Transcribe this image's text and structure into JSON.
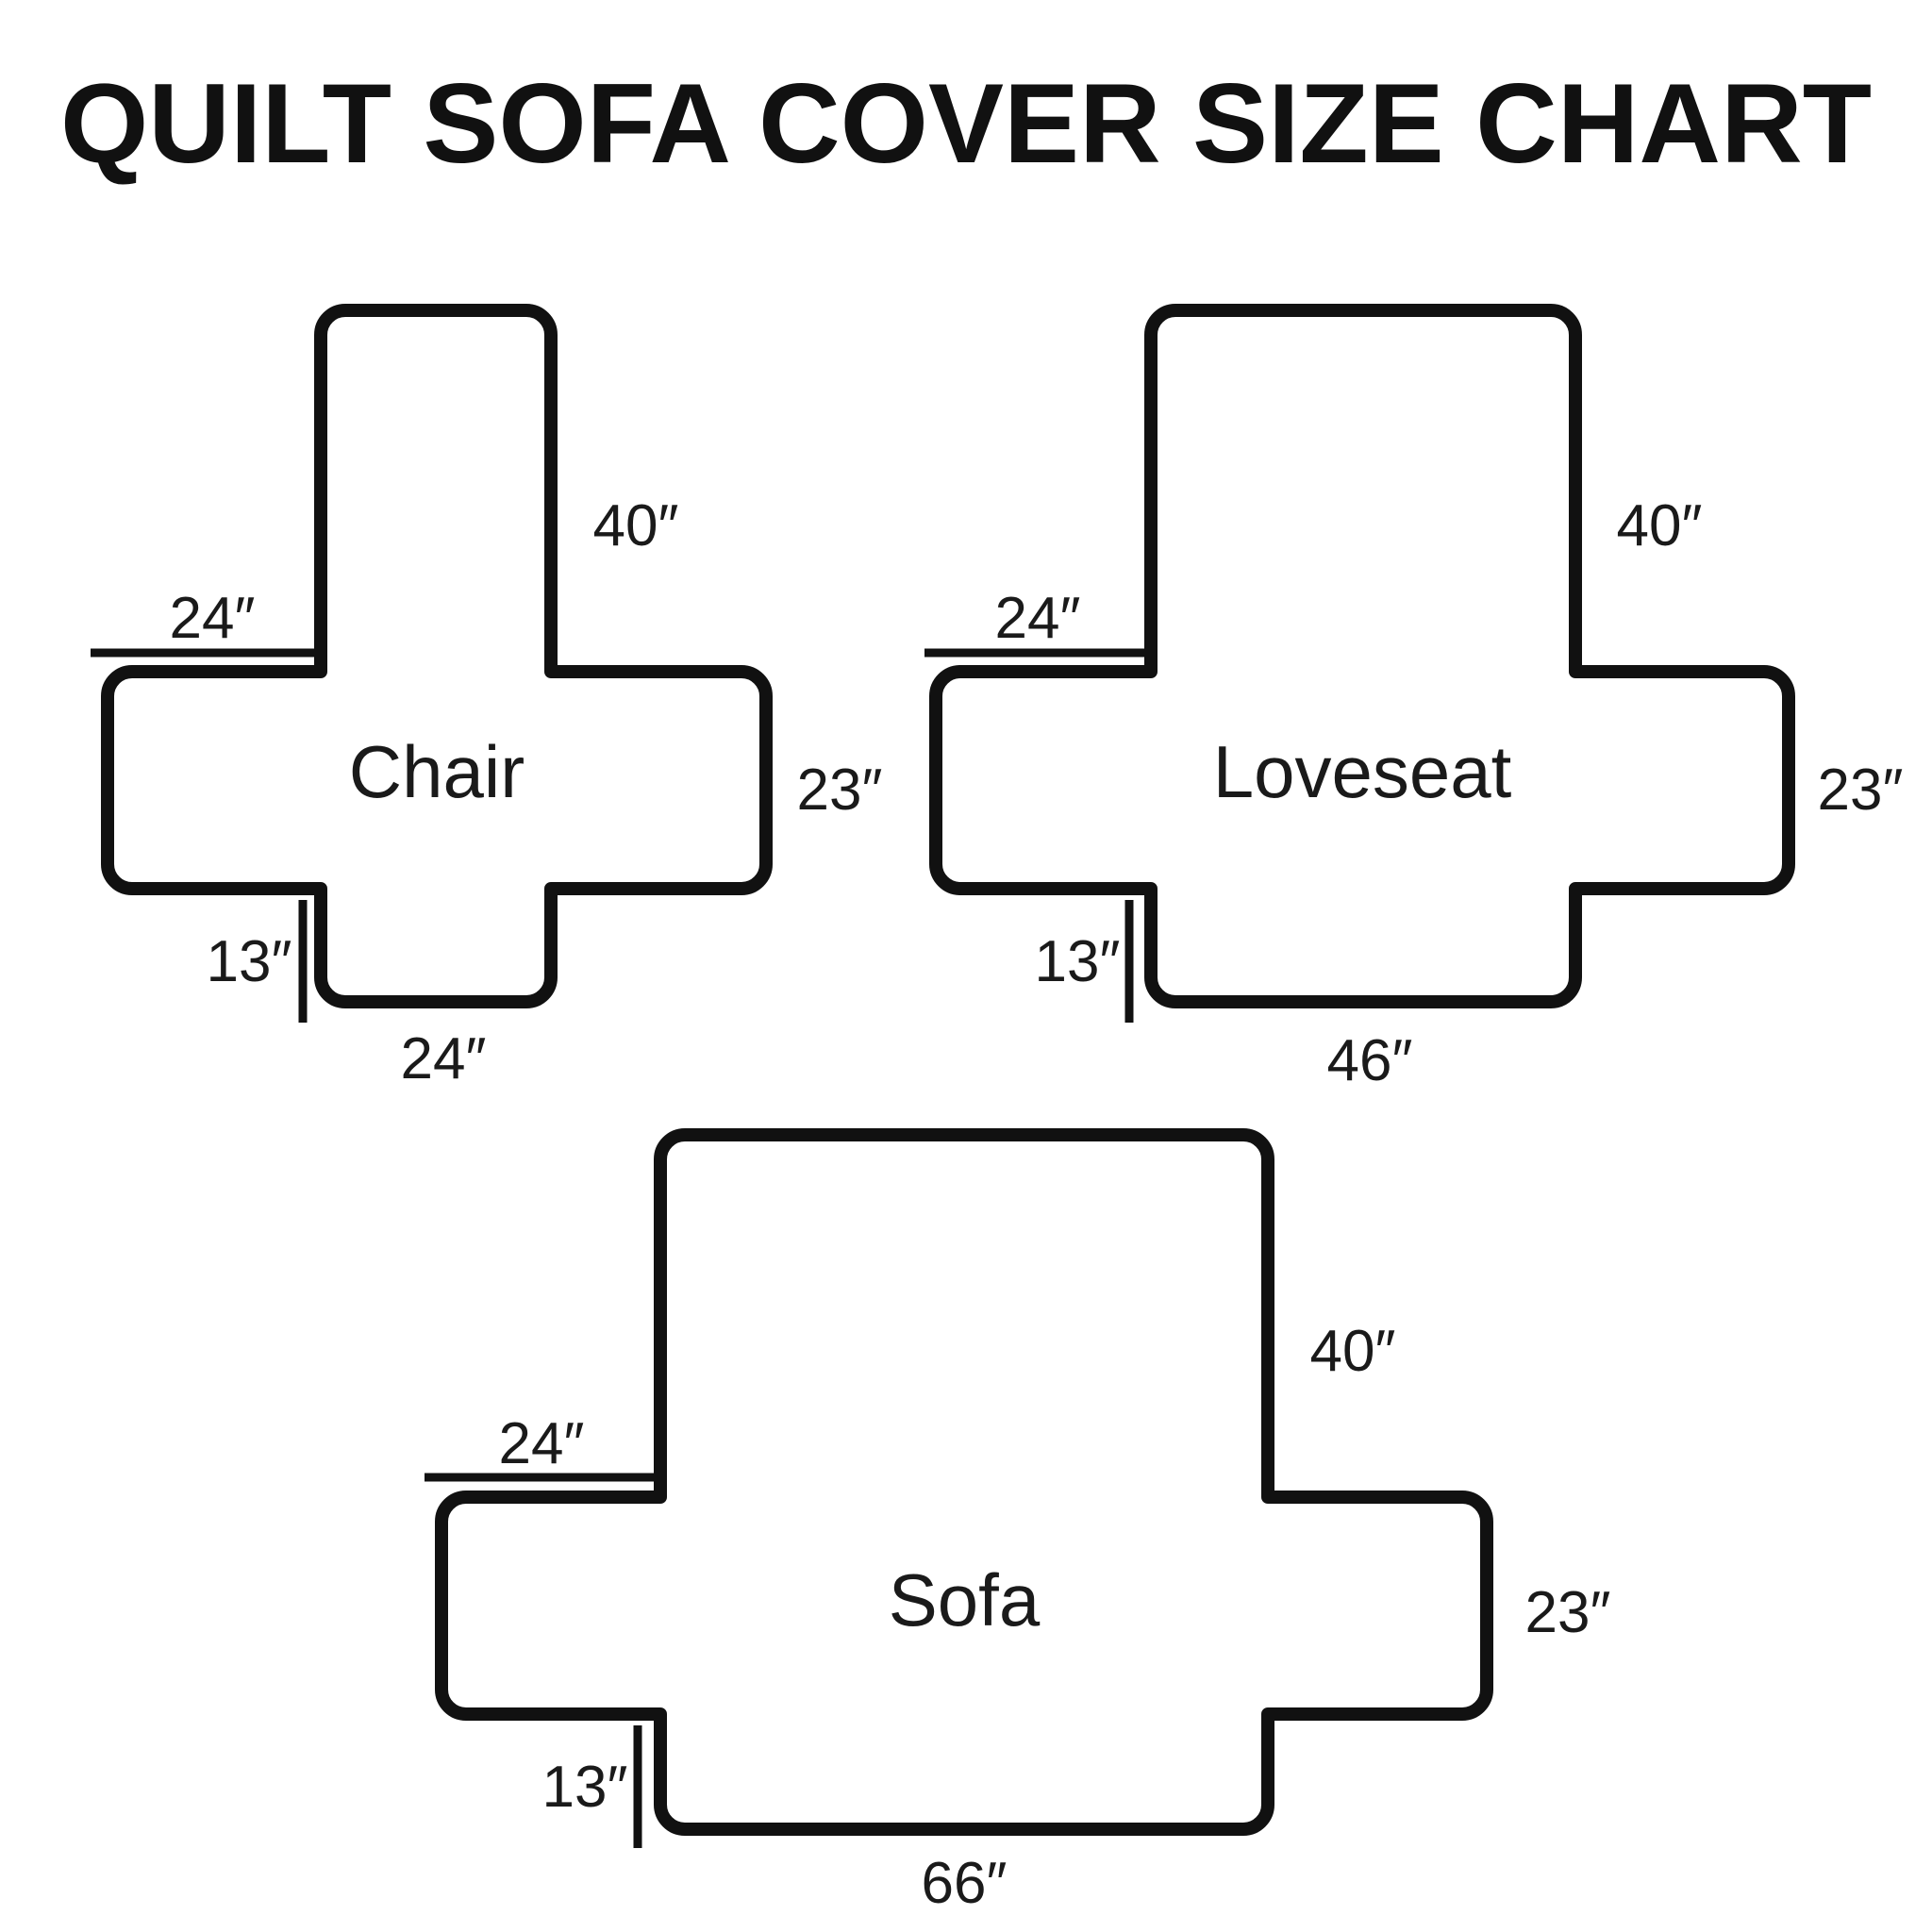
{
  "title": "QUILT SOFA COVER SIZE CHART",
  "diagrams": [
    {
      "name": "Chair",
      "dims": {
        "back_height": "40″",
        "arm_top": "24″",
        "side_height": "23″",
        "flap_height": "13″",
        "bottom_width": "24″"
      }
    },
    {
      "name": "Loveseat",
      "dims": {
        "back_height": "40″",
        "arm_top": "24″",
        "side_height": "23″",
        "flap_height": "13″",
        "bottom_width": "46″"
      }
    },
    {
      "name": "Sofa",
      "dims": {
        "back_height": "40″",
        "arm_top": "24″",
        "side_height": "23″",
        "flap_height": "13″",
        "bottom_width": "66″"
      }
    }
  ],
  "colors": {
    "ink": "#111111",
    "background": "#ffffff"
  }
}
